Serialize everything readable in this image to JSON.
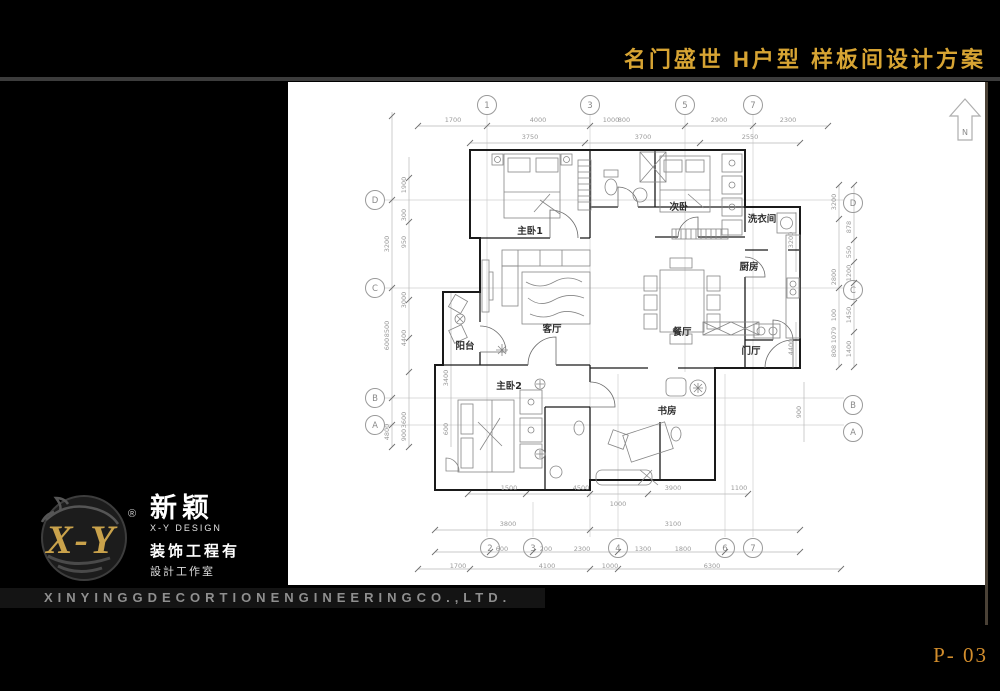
{
  "header": {
    "title": "名门盛世 H户型 样板间设计方案"
  },
  "footer": {
    "company_banner": "XINYINGGDECORTIONENGINEERINGCO.,LTD.",
    "page_number": "P- 03"
  },
  "logo": {
    "xy": "X-Y",
    "reg": "®",
    "cn_name": "新颖",
    "en_name": "X-Y DESIGN",
    "line1": "装饰工程有",
    "line2": "設計工作室"
  },
  "plan": {
    "north_label": "N",
    "rooms": [
      {
        "t": "主卧1",
        "x": 242,
        "y": 152
      },
      {
        "t": "次卧",
        "x": 391,
        "y": 128
      },
      {
        "t": "洗衣间",
        "x": 474,
        "y": 140
      },
      {
        "t": "厨房",
        "x": 461,
        "y": 188
      },
      {
        "t": "客厅",
        "x": 264,
        "y": 250
      },
      {
        "t": "餐厅",
        "x": 394,
        "y": 253
      },
      {
        "t": "门厅",
        "x": 463,
        "y": 272
      },
      {
        "t": "阳台",
        "x": 177,
        "y": 267
      },
      {
        "t": "主卧2",
        "x": 221,
        "y": 307
      },
      {
        "t": "书房",
        "x": 379,
        "y": 332
      }
    ],
    "bubbles": [
      {
        "t": "1",
        "x": 199,
        "y": 23
      },
      {
        "t": "3",
        "x": 302,
        "y": 23
      },
      {
        "t": "5",
        "x": 397,
        "y": 23
      },
      {
        "t": "7",
        "x": 465,
        "y": 23
      },
      {
        "t": "D",
        "x": 87,
        "y": 118
      },
      {
        "t": "C",
        "x": 87,
        "y": 206
      },
      {
        "t": "B",
        "x": 87,
        "y": 316
      },
      {
        "t": "A",
        "x": 87,
        "y": 343
      },
      {
        "t": "D",
        "x": 565,
        "y": 121
      },
      {
        "t": "C",
        "x": 565,
        "y": 208
      },
      {
        "t": "B",
        "x": 565,
        "y": 323
      },
      {
        "t": "A",
        "x": 565,
        "y": 350
      },
      {
        "t": "2",
        "x": 202,
        "y": 466
      },
      {
        "t": "3",
        "x": 245,
        "y": 466
      },
      {
        "t": "4",
        "x": 330,
        "y": 466
      },
      {
        "t": "6",
        "x": 437,
        "y": 466
      },
      {
        "t": "7",
        "x": 465,
        "y": 466
      }
    ],
    "dims": [
      {
        "t": "1700",
        "x": 165,
        "y": 40
      },
      {
        "t": "4000",
        "x": 250,
        "y": 40
      },
      {
        "t": "1000",
        "x": 323,
        "y": 40
      },
      {
        "t": "800",
        "x": 336,
        "y": 40
      },
      {
        "t": "2900",
        "x": 431,
        "y": 40
      },
      {
        "t": "2300",
        "x": 500,
        "y": 40
      },
      {
        "t": "3750",
        "x": 242,
        "y": 57
      },
      {
        "t": "3700",
        "x": 355,
        "y": 57
      },
      {
        "t": "2550",
        "x": 462,
        "y": 57
      },
      {
        "t": "1900",
        "x": 118,
        "y": 103,
        "r": -90
      },
      {
        "t": "300",
        "x": 118,
        "y": 133,
        "r": -90
      },
      {
        "t": "950",
        "x": 118,
        "y": 160,
        "r": -90
      },
      {
        "t": "3000",
        "x": 118,
        "y": 218,
        "r": -90
      },
      {
        "t": "4400",
        "x": 118,
        "y": 256,
        "r": -90
      },
      {
        "t": "3600",
        "x": 118,
        "y": 338,
        "r": -90
      },
      {
        "t": "900",
        "x": 118,
        "y": 353,
        "r": -90
      },
      {
        "t": "3200",
        "x": 101,
        "y": 162,
        "r": -90
      },
      {
        "t": "8500",
        "x": 101,
        "y": 247,
        "r": -90
      },
      {
        "t": "600",
        "x": 101,
        "y": 262,
        "r": -90
      },
      {
        "t": "4800",
        "x": 101,
        "y": 350,
        "r": -90
      },
      {
        "t": "3400",
        "x": 160,
        "y": 296,
        "r": -90
      },
      {
        "t": "600",
        "x": 160,
        "y": 347,
        "r": -90
      },
      {
        "t": "3200",
        "x": 548,
        "y": 120,
        "r": -90
      },
      {
        "t": "2800",
        "x": 548,
        "y": 195,
        "r": -90
      },
      {
        "t": "100",
        "x": 548,
        "y": 233,
        "r": -90
      },
      {
        "t": "1079",
        "x": 548,
        "y": 253,
        "r": -90
      },
      {
        "t": "808",
        "x": 548,
        "y": 269,
        "r": -90
      },
      {
        "t": "878",
        "x": 563,
        "y": 145,
        "r": -90
      },
      {
        "t": "550",
        "x": 563,
        "y": 170,
        "r": -90
      },
      {
        "t": "1200",
        "x": 563,
        "y": 191,
        "r": -90
      },
      {
        "t": "1450",
        "x": 563,
        "y": 233,
        "r": -90
      },
      {
        "t": "1400",
        "x": 563,
        "y": 267,
        "r": -90
      },
      {
        "t": "3200",
        "x": 505,
        "y": 158,
        "r": -90
      },
      {
        "t": "4400",
        "x": 505,
        "y": 265,
        "r": -90
      },
      {
        "t": "900",
        "x": 513,
        "y": 330,
        "r": -90
      },
      {
        "t": "1500",
        "x": 221,
        "y": 408
      },
      {
        "t": "4500",
        "x": 293,
        "y": 408
      },
      {
        "t": "3900",
        "x": 385,
        "y": 408
      },
      {
        "t": "1100",
        "x": 451,
        "y": 408
      },
      {
        "t": "1000",
        "x": 330,
        "y": 424
      },
      {
        "t": "3800",
        "x": 220,
        "y": 444
      },
      {
        "t": "3100",
        "x": 385,
        "y": 444
      },
      {
        "t": "600",
        "x": 214,
        "y": 469
      },
      {
        "t": "200",
        "x": 258,
        "y": 469
      },
      {
        "t": "2300",
        "x": 294,
        "y": 469
      },
      {
        "t": "1300",
        "x": 355,
        "y": 469
      },
      {
        "t": "1800",
        "x": 395,
        "y": 469
      },
      {
        "t": "1700",
        "x": 170,
        "y": 486
      },
      {
        "t": "4100",
        "x": 259,
        "y": 486
      },
      {
        "t": "1000",
        "x": 322,
        "y": 486
      },
      {
        "t": "6300",
        "x": 424,
        "y": 486
      }
    ]
  }
}
